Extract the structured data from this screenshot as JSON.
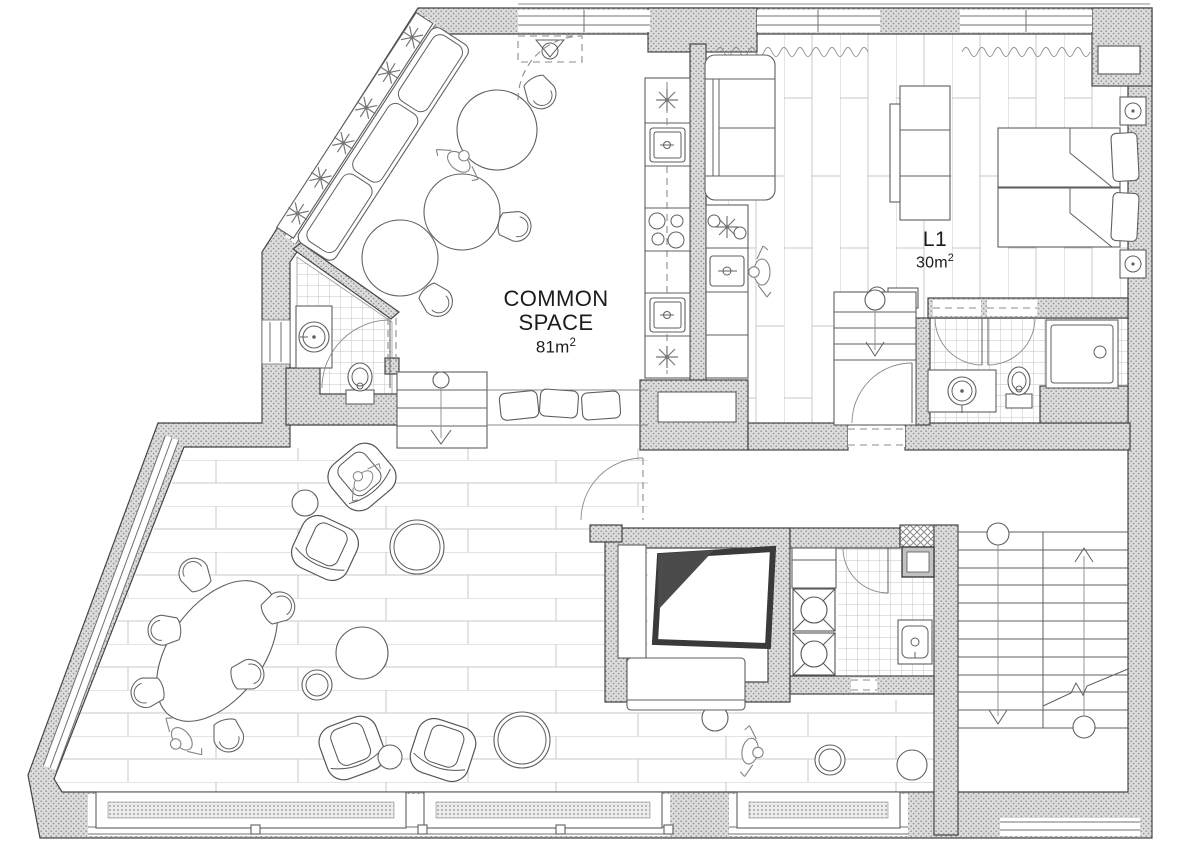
{
  "plan": {
    "background": "#ffffff",
    "labels": {
      "common_space": {
        "name": "COMMON SPACE",
        "area": "81m",
        "area_sup": "2"
      },
      "unit_l1": {
        "name": "L1",
        "area": "30m",
        "area_sup": "2"
      }
    },
    "palette": {
      "wall_fill": "#dcdcdc",
      "wall_speckle": "#909090",
      "wall_edge": "#454545",
      "furniture_line": "#5f5f5f",
      "floor_line": "#c9c9c9",
      "tile_line": "#c3c3c3",
      "dark_panel": "#4b4b4b",
      "text": "#1b1b1b"
    },
    "rooms": [
      "common-space",
      "unit-l1-bedroom",
      "bathroom-l1",
      "wc-common",
      "kitchen",
      "living-lounge",
      "corridor",
      "laundry",
      "media-room",
      "stairwell",
      "entry-stair"
    ],
    "furniture_icons": [
      "sofa",
      "twin-bed",
      "pillow",
      "wardrobe",
      "nightstand-lamp",
      "round-table",
      "tub-chair",
      "armchair",
      "pouf",
      "coffee-table",
      "dining-oval-table",
      "floor-cushion",
      "kitchen-sink",
      "cooktop",
      "burner-star",
      "washing-machine",
      "shower-tray",
      "toilet",
      "washbasin",
      "window-bench",
      "radiator",
      "stair-up-arrow",
      "stair-down-arrow",
      "plant",
      "person-figure",
      "entrance-mat",
      "door-swing"
    ]
  }
}
